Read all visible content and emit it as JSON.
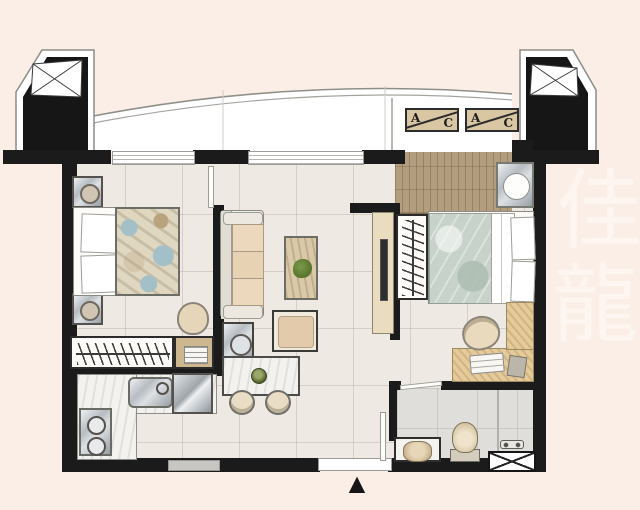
{
  "ac": {
    "units": [
      {
        "a": "A",
        "c": "C"
      },
      {
        "a": "A",
        "c": "C"
      }
    ]
  },
  "entrance": {
    "arrow_glyph": "▲"
  },
  "watermark": {
    "char1": "佳",
    "char2": "龍"
  },
  "colors": {
    "background": "#fbeee7",
    "wall": "#1b1b1b",
    "floor_tile": "#efe9e3",
    "bath_floor": "#e0dedb",
    "deck_wood": "#b29d7f",
    "desk_wood": "#e5cb9b",
    "balcony": "#ffffff",
    "quilt_left_accent": "#a3c0c9",
    "quilt_right": "#c7d2ca",
    "ac_box": "#d9c6a2"
  }
}
